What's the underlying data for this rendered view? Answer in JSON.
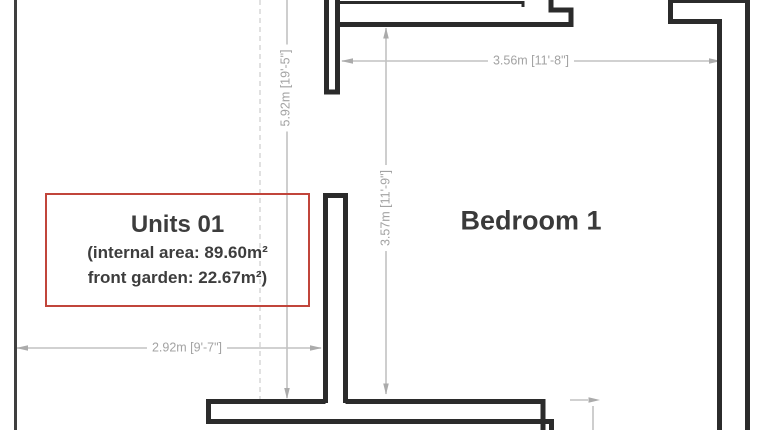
{
  "title_block": {
    "title": "Units 01",
    "internal_area_line": "(internal area: 89.60m²",
    "front_garden_line": "front garden: 22.67m²)"
  },
  "rooms": {
    "bedroom1": "Bedroom 1"
  },
  "dimensions": {
    "bedroom_width": "3.56m [11'-8\"]",
    "bedroom_depth": "3.57m [11'-9\"]",
    "overall_height": "5.92m [19'-5\"]",
    "garden_width": "2.92m [9'-7\"]"
  },
  "colors": {
    "wall": "#2b2b2b",
    "dimension_line": "#c2c2c2",
    "dimension_text": "#a3a3a3",
    "label_border": "#c1453b",
    "label_text": "#3d3d3d"
  }
}
